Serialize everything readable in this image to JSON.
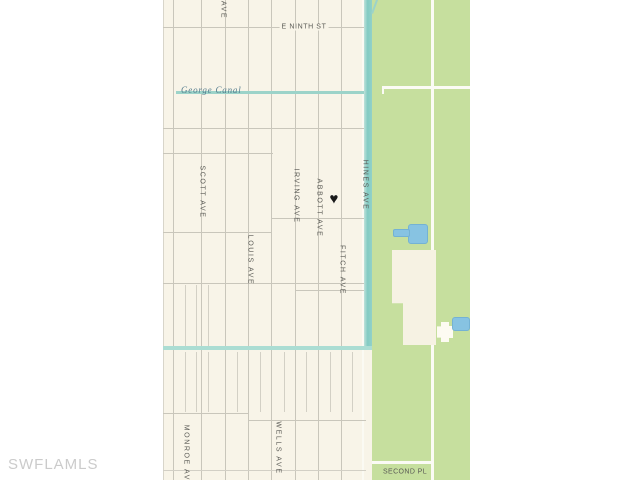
{
  "watermark": "SWFLAMLS",
  "map": {
    "street_labels": {
      "top_partial": "AVE",
      "e_ninth": "E NINTH ST",
      "scott": "SCOTT AVE",
      "irving": "IRVING AVE",
      "abbott": "ABBOTT AVE",
      "hines": "HINES AVE",
      "fitch": "FITCH AVE",
      "louis": "LOUIS AVE",
      "monroe": "MONROE AVE",
      "wells": "WELLS AVE",
      "second_pl": "SECOND PL"
    },
    "canal_label": "George Canal",
    "marker_symbol": "♥",
    "colors": {
      "land": "#f8f4e8",
      "preserve_green": "#c6df9e",
      "canal_teal": "#8fd0c8",
      "canal_teal_light": "#abddd3",
      "pond_blue": "#87c3e2",
      "street_line_gray": "#c9c6bb",
      "label_text": "#5a5a55",
      "canal_label_text": "#567d8e",
      "marker_black": "#191919",
      "watermark_gray": "#cbcbcb"
    }
  }
}
